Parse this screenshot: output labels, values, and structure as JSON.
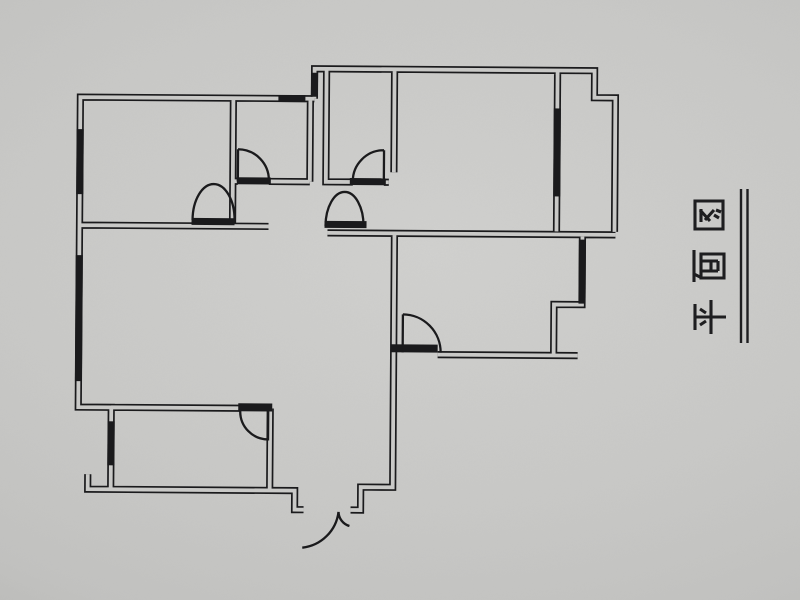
{
  "photo": {
    "subject": "apartment floor plan line drawing photographed on gray paper",
    "paper_color": "#c9c9c7",
    "ink_color": "#1a1a1c"
  },
  "label": {
    "text": "平面图",
    "orientation": "rotated 90 degrees counter-clockwise, read bottom to top",
    "underline": "double line"
  },
  "plan_symbols": {
    "door_swing_arcs": 8,
    "window_markers": 7
  }
}
